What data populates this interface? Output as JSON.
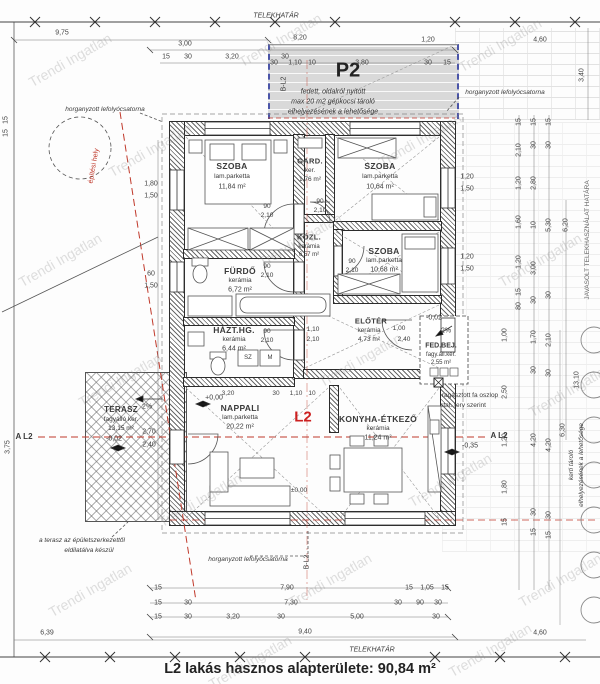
{
  "boundary": {
    "top": "TELEKHATÁR",
    "bottom": "TELEKHATÁR"
  },
  "caption": "L2 lakás hasznos alapterülete: 90,84 m²",
  "watermark": "Trendi Ingatlan",
  "unit_label": "L2",
  "carport": {
    "title": "P2",
    "line1": "fedett, oldalról nyitott",
    "line2": "max 20 m2 gépkocsi tároló",
    "line3": "elhelyezésének a lehetősége"
  },
  "markers": {
    "b_l2": "B-L2",
    "a_l2": "A L2"
  },
  "rooms": {
    "szoba1": {
      "name": "SZOBA",
      "finish": "lam.parketta",
      "area": "11,84 m²"
    },
    "gard": {
      "name": "GARD.",
      "finish": "ker.",
      "area": "1,76 m²"
    },
    "szoba2": {
      "name": "SZOBA",
      "finish": "lam.parketta",
      "area": "10,64 m²"
    },
    "kozl": {
      "name": "KÖZL.",
      "finish": "kerámia",
      "area": "6,57 m²"
    },
    "szoba3": {
      "name": "SZOBA",
      "finish": "lam.parketta",
      "area": "10,68 m²"
    },
    "furdo": {
      "name": "FÜRDŐ",
      "finish": "kerámia",
      "area": "6,72 m²"
    },
    "hazthg": {
      "name": "HÁZT.HG.",
      "finish": "kerámia",
      "area": "6,44 m²"
    },
    "eloter": {
      "name": "ELŐTÉR",
      "finish": "kerámia",
      "area": "4,73 m²"
    },
    "fedbej": {
      "name": "FED.BEJ.",
      "finish": "fagy.áll.ker.",
      "area": "2,55 m²"
    },
    "nappali": {
      "name": "NAPPALI",
      "finish": "lam.parketta",
      "area": "20,22 m²"
    },
    "konyha": {
      "name": "KONYHA-ÉTKEZŐ",
      "finish": "kerámia",
      "area": "11,24 m²"
    },
    "terasz": {
      "name": "TERASZ",
      "finish": "fagyálló ker.",
      "area": "13,15 m²"
    }
  },
  "levels": {
    "zero": "+0,00",
    "pm": "±0,00",
    "terasz": "-0,02",
    "fedbej": "-0,02",
    "outside": "-0,35"
  },
  "slope": "2%",
  "appliances": {
    "sz": "SZ",
    "m": "M"
  },
  "notes": {
    "gutter": "horganyzott lefolyócsatorna",
    "site_line": "építési hely",
    "terrace_note1": "a terasz az épületszerkezettől",
    "terrace_note2": "eldilatálva készül",
    "column1": "ragasztott fa oszlop",
    "column2": "stat. terv szerint",
    "garden1": "kerti tároló",
    "garden2": "elhelyezésének a lehetősége",
    "proposed": "JAVASOLT TELEKHASZNÁLAT HATÁRA"
  },
  "openings": {
    "w90": "90",
    "h210": "2,10",
    "w100": "1,00",
    "h240": "2,40",
    "w110": "1,10"
  },
  "dims": {
    "top": [
      "9,75",
      "3,00",
      "15",
      "30",
      "3,20",
      "30",
      "8,20",
      "1,20",
      "4,60",
      "3,40"
    ],
    "p2row": [
      "30",
      "1,10",
      "10",
      "3,80",
      "30",
      "15"
    ],
    "nap": [
      "3,20",
      "30",
      "1,10",
      "10"
    ],
    "b1": [
      "15",
      "7,90",
      "15",
      "1,05",
      "15"
    ],
    "b2": [
      "15",
      "30",
      "7,30",
      "30",
      "90",
      "30"
    ],
    "b3": [
      "15",
      "30",
      "3,20",
      "30",
      "5,00",
      "30"
    ],
    "b4": [
      "9,40"
    ],
    "b5": [
      "6,39",
      "4,60"
    ],
    "left": [
      "1,80",
      "1,50",
      "60",
      "1,50",
      "2,70",
      "2,40",
      "3,75",
      "15",
      "15"
    ],
    "r1": [
      "15",
      "2,10",
      "1,20",
      "1,60",
      "1,20",
      "15",
      "80"
    ],
    "r2": [
      "15",
      "30",
      "2,80",
      "10",
      "3,00",
      "30",
      "1,70",
      "30",
      "4,20",
      "30",
      "15"
    ],
    "r3": [
      "15",
      "30",
      "5,30",
      "30",
      "2,10",
      "30",
      "4,20",
      "30",
      "15"
    ],
    "r4": [
      "6,20",
      "13,10",
      "6,30"
    ],
    "r5": [
      "1,00",
      "2,50",
      "1,20",
      "1,80",
      "15"
    ],
    "winr": [
      "1,20",
      "1,50",
      "1,20",
      "1,50"
    ]
  }
}
